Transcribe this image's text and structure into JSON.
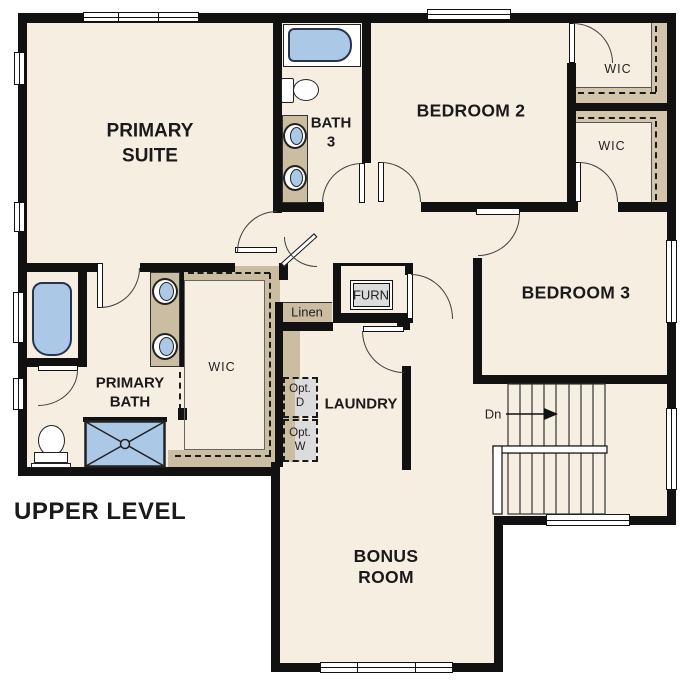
{
  "plan_title": "UPPER LEVEL",
  "rooms": {
    "primary_suite_lines": [
      "PRIMARY",
      "SUITE"
    ],
    "bath3_lines": [
      "BATH",
      "3"
    ],
    "bedroom2": "BEDROOM 2",
    "bedroom3": "BEDROOM 3",
    "wic_bedroom2": "WIC",
    "wic_bedroom3": "WIC",
    "wic_primary": "WIC",
    "primary_bath_lines": [
      "PRIMARY",
      "BATH"
    ],
    "laundry": "LAUNDRY",
    "bonus_room_lines": [
      "BONUS",
      "ROOM"
    ],
    "linen": "Linen",
    "furnace": "FURN",
    "opt_dryer_lines": [
      "Opt.",
      "D"
    ],
    "opt_washer_lines": [
      "Opt.",
      "W"
    ],
    "stair_direction": "Dn"
  },
  "colors": {
    "background": "#ffffff",
    "floor": "#f6eee1",
    "wall": "#111111",
    "casework_tan": "#cbbda1",
    "fixture_blue": "#abc8e6",
    "equipment_gray": "#dcdcdc",
    "text": "#1a1a1a"
  }
}
